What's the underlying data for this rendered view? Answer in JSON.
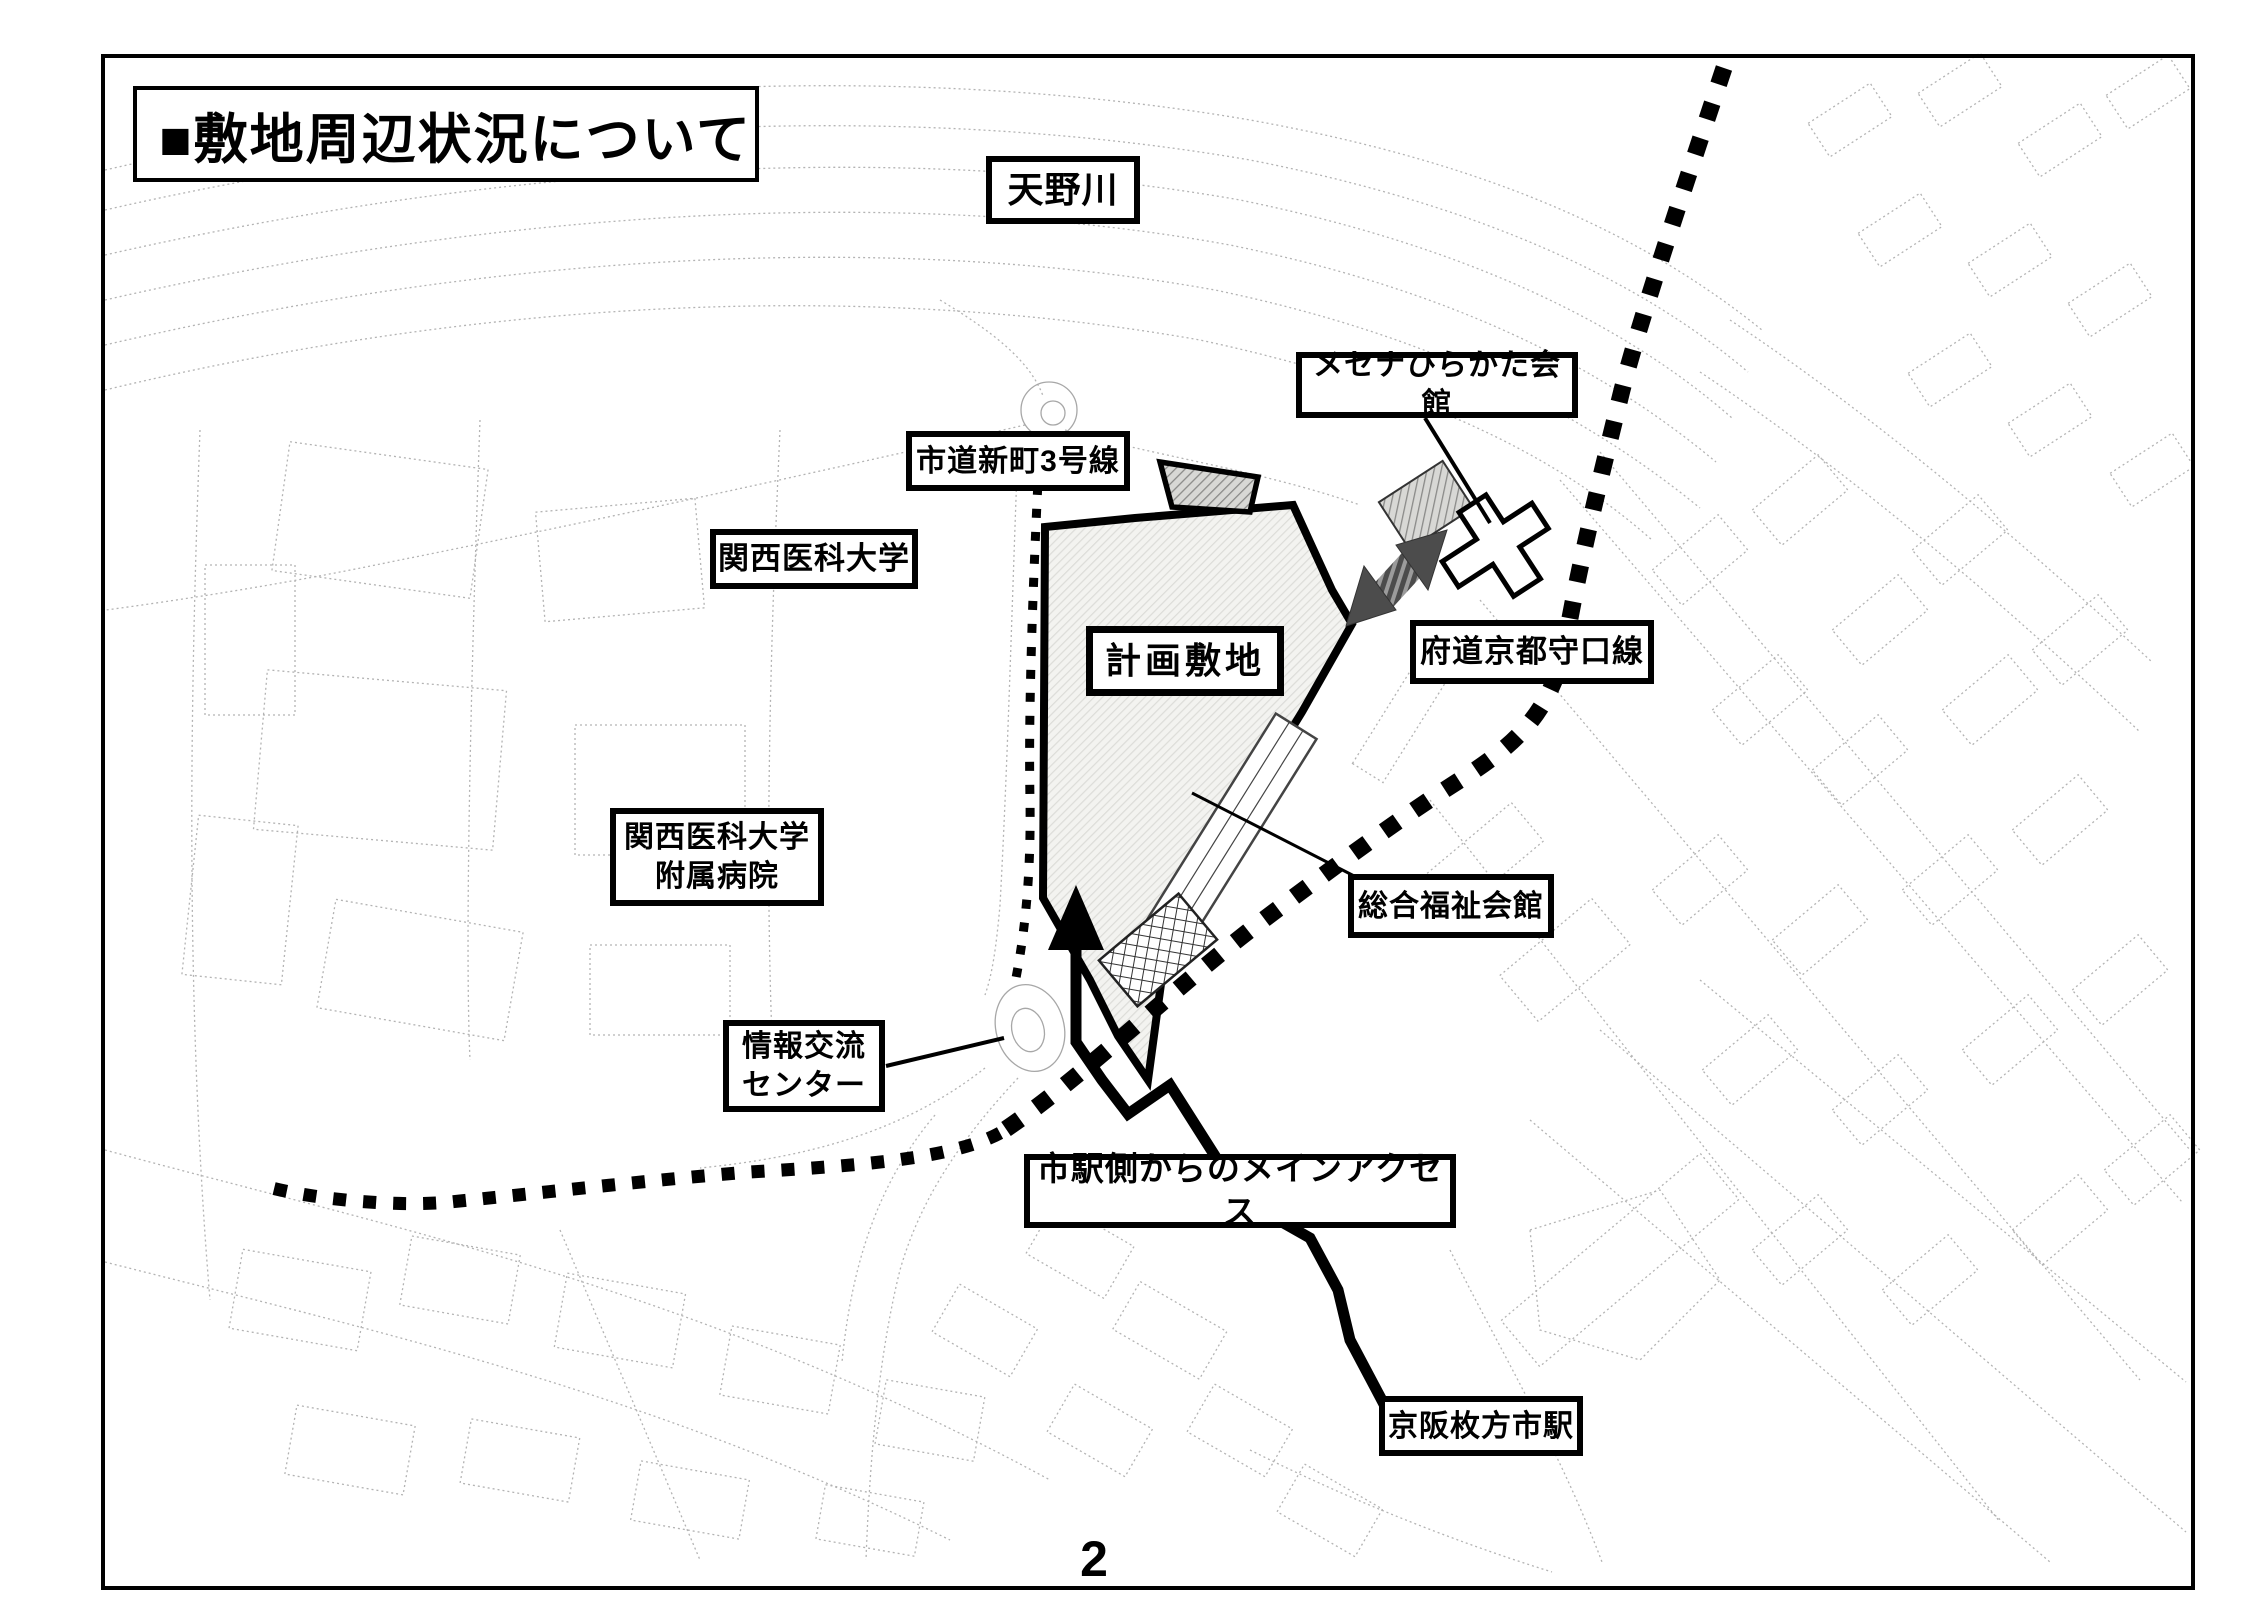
{
  "page": {
    "title": "■敷地周辺状況について",
    "page_number": "2"
  },
  "map": {
    "labels": [
      {
        "id": "amanogawa-river",
        "text": "天野川"
      },
      {
        "id": "mecenat-hirakata-hall",
        "text": "メセナひらかた会館"
      },
      {
        "id": "city-road-shinmachi-3",
        "text": "市道新町3号線"
      },
      {
        "id": "kansai-medical-university",
        "text": "関西医科大学"
      },
      {
        "id": "planned-site",
        "text": "計画敷地"
      },
      {
        "id": "pref-road-kyoto-moriguchi",
        "text": "府道京都守口線"
      },
      {
        "id": "kansai-medical-university-hospital",
        "text": "関西医科大学\n附属病院"
      },
      {
        "id": "general-welfare-hall",
        "text": "総合福祉会館"
      },
      {
        "id": "information-exchange-center",
        "text": "情報交流\nセンター"
      },
      {
        "id": "main-access-from-station",
        "text": "市駅側からのメインアクセス"
      },
      {
        "id": "keihan-hirakatashi-station",
        "text": "京阪枚方市駅"
      }
    ],
    "colors": {
      "ink": "#000000",
      "faint_linework": "#999999",
      "site_fill": "#f3f3f0",
      "arrow_gray": "#4c4c4c"
    }
  }
}
